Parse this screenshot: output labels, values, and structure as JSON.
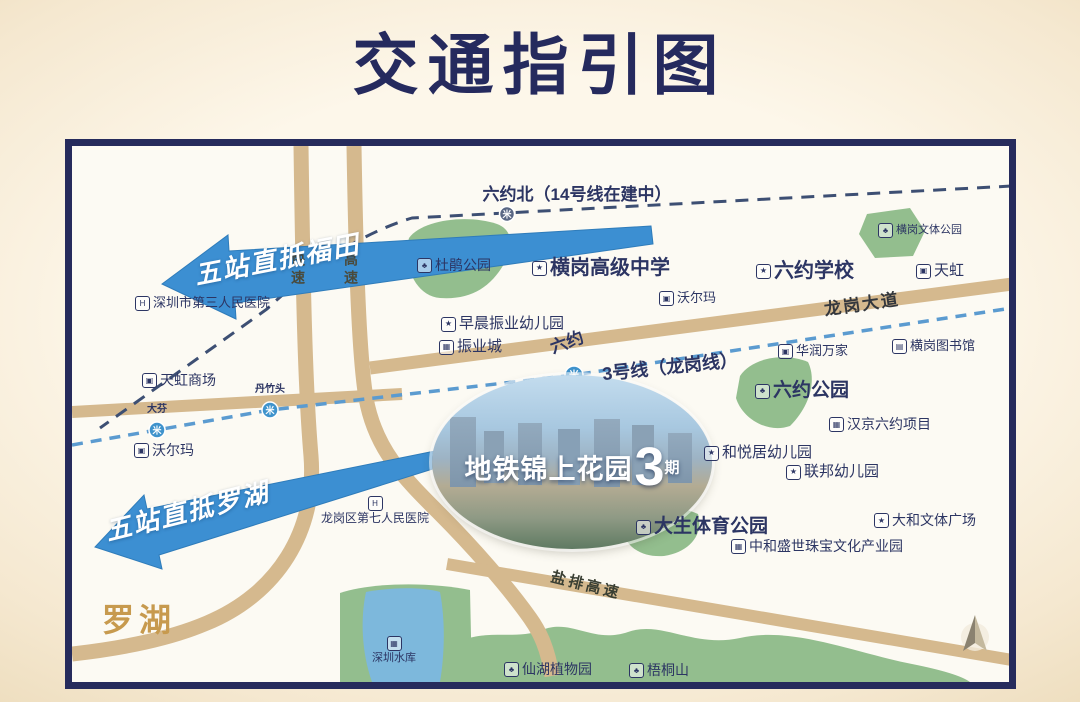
{
  "title": "交通指引图",
  "colors": {
    "title_navy": "#252a5e",
    "arrow_blue": "#3c8fd2",
    "line3_blue": "#5b9bd0",
    "line14_navy": "#3d4f73",
    "road_tan": "#d5b98e",
    "park_green": "#93be8e",
    "water_blue": "#7db8dc",
    "label_navy": "#2c3563",
    "luohu_gold": "#c79a4e",
    "background_cream": "#f7ecd9",
    "map_border_navy": "#262b5c"
  },
  "icon_glyphs": {
    "hospital": "H",
    "school": "★",
    "shop": "▣",
    "park": "♣",
    "building": "▦",
    "library": "▤"
  },
  "map": {
    "arrows": [
      {
        "label": "五站直抵福田"
      },
      {
        "label": "五站直抵罗湖"
      }
    ],
    "metro": {
      "line14_station_label": "六约北（14号线在建中）",
      "line3_label": "3号线（龙岗线）",
      "liuyue_label": "六约",
      "logo_glyph": "米",
      "station_labels": [
        "大芬",
        "丹竹头"
      ]
    },
    "roads": {
      "kuaisu": "快速",
      "gaosu": "高速",
      "longgang_avenue": "龙岗大道",
      "yanpai_expressway": "盐排高速"
    },
    "areas": {
      "luohu": "罗湖"
    },
    "project": {
      "prefix": "地铁锦上花园",
      "big": "3",
      "suffix": "期"
    },
    "pois": [
      {
        "label": "六约北（14号线在建中）",
        "type": null,
        "x": 505,
        "y": 40,
        "size": 17,
        "bold": true,
        "center": true
      },
      {
        "label": "深圳市第三人民医院",
        "type": "hospital",
        "x": 63,
        "y": 150,
        "size": 13
      },
      {
        "label": "天虹商场",
        "type": "shop",
        "x": 70,
        "y": 227,
        "size": 14
      },
      {
        "label": "沃尔玛",
        "type": "shop",
        "x": 62,
        "y": 297,
        "size": 14
      },
      {
        "label": "大芬",
        "type": null,
        "x": 85,
        "y": 258,
        "size": 10,
        "center": true,
        "tiny": true
      },
      {
        "label": "丹竹头",
        "type": null,
        "x": 198,
        "y": 238,
        "size": 10,
        "center": true,
        "tiny": true
      },
      {
        "label": "杜鹃公园",
        "type": "park",
        "x": 345,
        "y": 112,
        "size": 14
      },
      {
        "label": "横岗高级中学",
        "type": "school",
        "x": 460,
        "y": 111,
        "size": 20,
        "bold": true
      },
      {
        "label": "六约学校",
        "type": "school",
        "x": 684,
        "y": 114,
        "size": 20,
        "bold": true
      },
      {
        "label": "天虹",
        "type": "shop",
        "x": 844,
        "y": 117,
        "size": 15
      },
      {
        "label": "横岗文体公园",
        "type": "park",
        "x": 806,
        "y": 77,
        "size": 11
      },
      {
        "label": "沃尔玛",
        "type": "shop",
        "x": 587,
        "y": 145,
        "size": 13
      },
      {
        "label": "早晨振业幼儿园",
        "type": "school",
        "x": 369,
        "y": 170,
        "size": 15
      },
      {
        "label": "振业城",
        "type": "building",
        "x": 367,
        "y": 193,
        "size": 15
      },
      {
        "label": "华润万家",
        "type": "shop",
        "x": 706,
        "y": 198,
        "size": 13
      },
      {
        "label": "横岗图书馆",
        "type": "library",
        "x": 820,
        "y": 193,
        "size": 13
      },
      {
        "label": "六约公园",
        "type": "park",
        "x": 683,
        "y": 235,
        "size": 19,
        "bold": true
      },
      {
        "label": "汉京六约项目",
        "type": "building",
        "x": 757,
        "y": 271,
        "size": 14
      },
      {
        "label": "和悦居幼儿园",
        "type": "school",
        "x": 632,
        "y": 299,
        "size": 15
      },
      {
        "label": "联邦幼儿园",
        "type": "school",
        "x": 714,
        "y": 318,
        "size": 15
      },
      {
        "label": "大和文体广场",
        "type": "school",
        "x": 802,
        "y": 367,
        "size": 14
      },
      {
        "label": "大生体育公园",
        "type": "park",
        "x": 564,
        "y": 371,
        "size": 19,
        "bold": true
      },
      {
        "label": "中和盛世珠宝文化产业园",
        "type": "building",
        "x": 659,
        "y": 393,
        "size": 14
      },
      {
        "label": "龙岗区第七人民医院",
        "type": "hospital",
        "x": 303,
        "y": 350,
        "size": 12,
        "stacked": true
      },
      {
        "label": "深圳水库",
        "type": "building",
        "x": 322,
        "y": 490,
        "size": 11,
        "stacked": true
      },
      {
        "label": "仙湖植物园",
        "type": "park",
        "x": 432,
        "y": 516,
        "size": 14
      },
      {
        "label": "梧桐山",
        "type": "park",
        "x": 557,
        "y": 517,
        "size": 14
      }
    ]
  }
}
